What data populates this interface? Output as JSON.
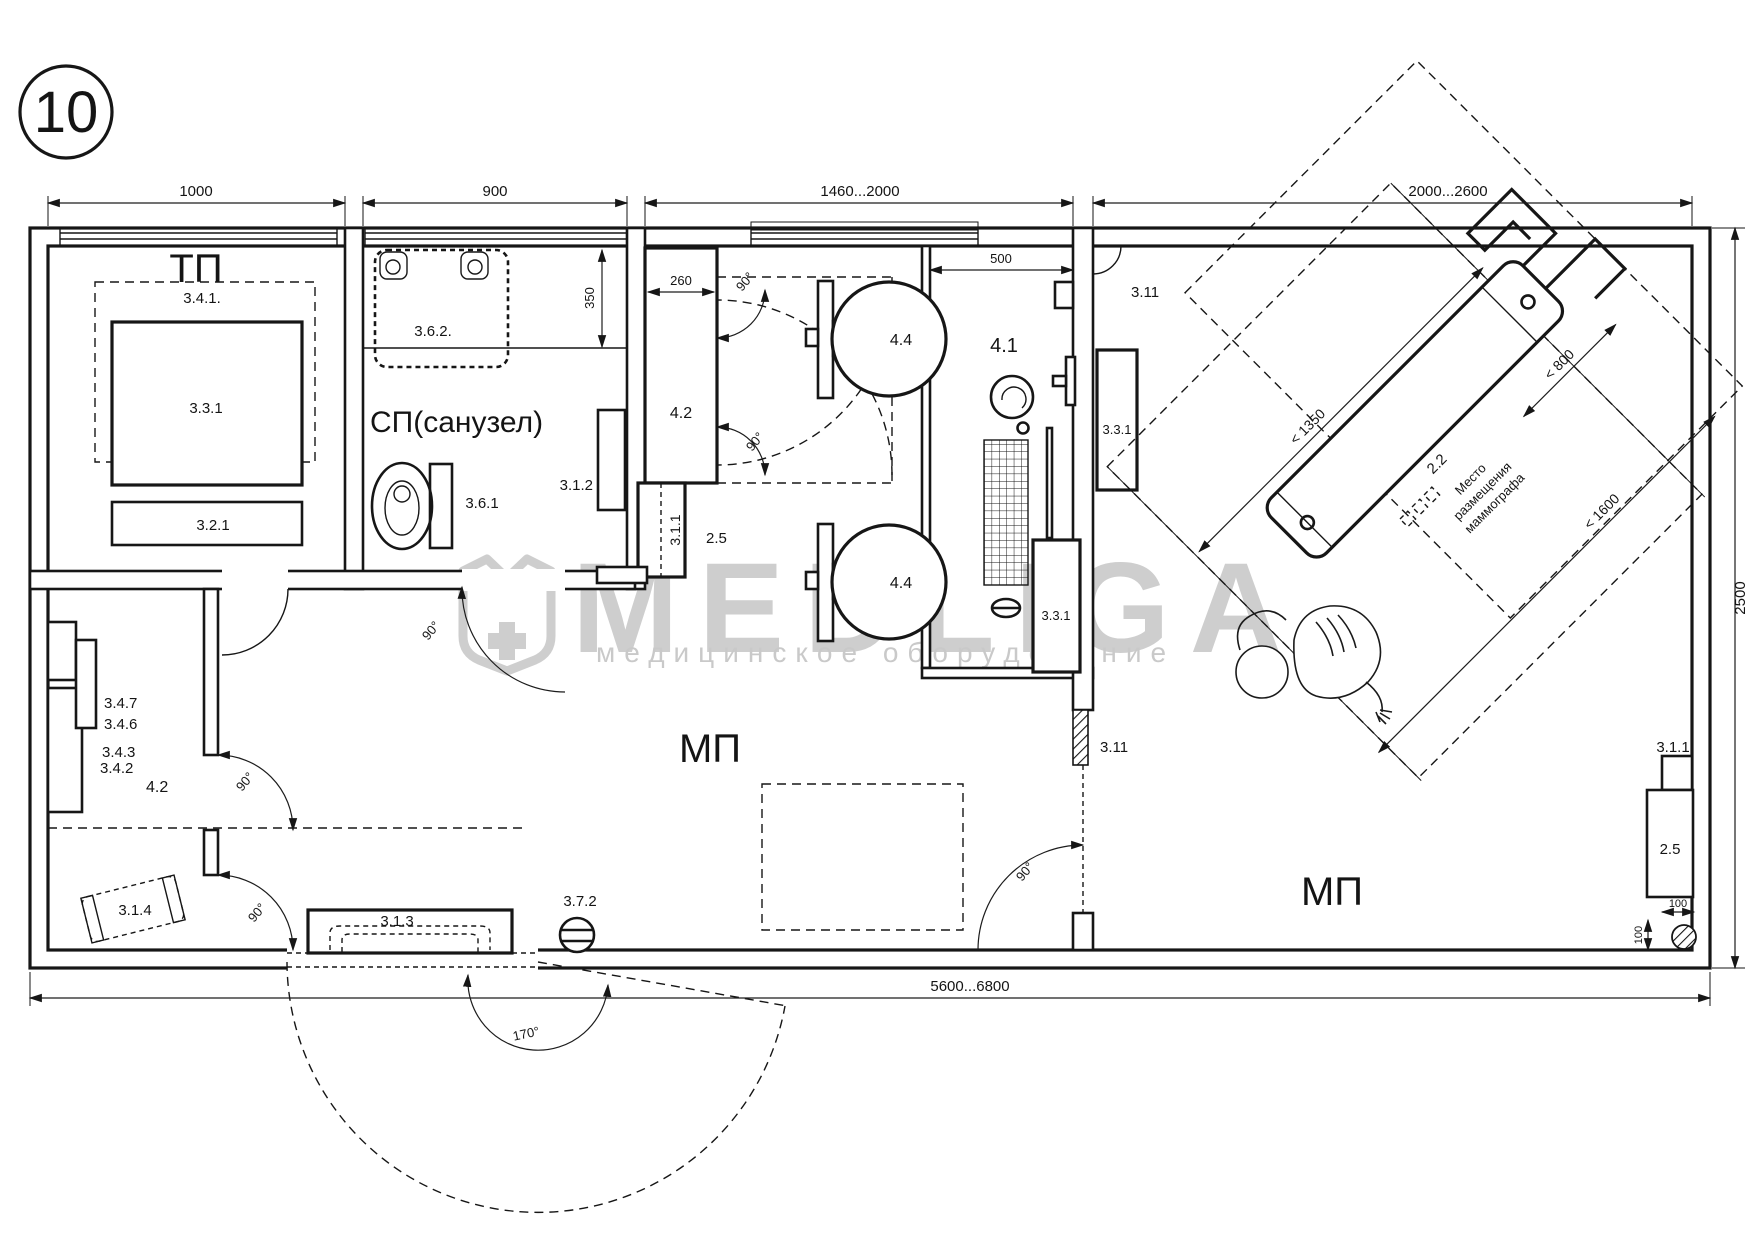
{
  "plan": {
    "number": "10"
  },
  "watermark": {
    "brand": "MEDLIGA",
    "tagline": "медицинское оборудование"
  },
  "rooms": {
    "tp": "ТП",
    "sp": "СП(санузел)",
    "mp_left": "МП",
    "mp_right": "МП"
  },
  "dims": {
    "d1000": "1000",
    "d900": "900",
    "d1460": "1460...2000",
    "d2000": "2000...2600",
    "d2500": "2500",
    "d5600": "5600...6800",
    "d350": "350",
    "d260": "260",
    "d500": "500",
    "d100a": "100",
    "d100b": "100",
    "m1350": "< 1350",
    "m800": "< 800",
    "m1600": "< 1600"
  },
  "angles": {
    "deg90": "90°",
    "deg170": "170°"
  },
  "items": {
    "i341": "3.4.1.",
    "i331_tp": "3.3.1",
    "i321": "3.2.1",
    "i362": "3.6.2.",
    "i361": "3.6.1",
    "i312": "3.1.2",
    "i42_cab": "4.2",
    "i311_col": "3.1.1",
    "i25_col": "2.5",
    "i44_a": "4.4",
    "i44_b": "4.4",
    "i41": "4.1",
    "i331_cor": "3.3.1",
    "i311_top": "3.11",
    "i331_r": "3.3.1",
    "i311_vent": "3.11",
    "i22": "2.2",
    "i347": "3.4.7",
    "i346": "3.4.6",
    "i343": "3.4.3",
    "i342": "3.4.2",
    "i42_l": "4.2",
    "i314": "3.1.4",
    "i313": "3.1.3",
    "i372": "3.7.2",
    "i311_w": "3.1.1",
    "i25_w": "2.5"
  },
  "mammo_note": {
    "line1": "Место",
    "line2": "размещения",
    "line3": "маммографа"
  }
}
